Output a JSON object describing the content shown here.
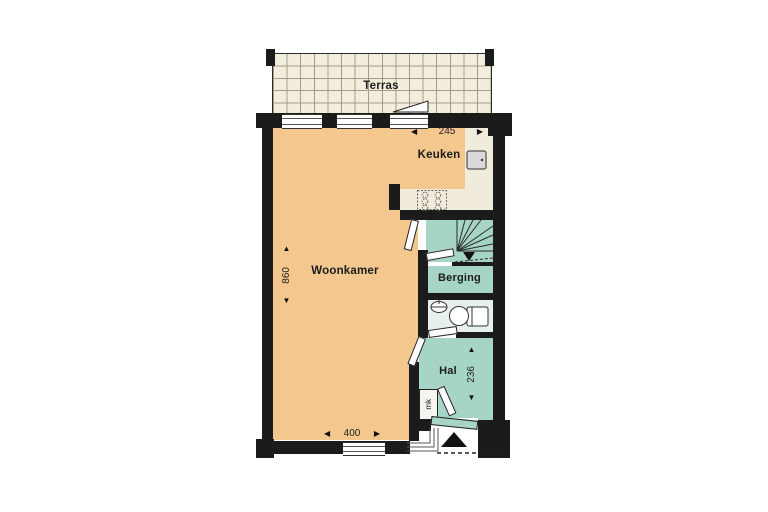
{
  "rooms": {
    "terras": "Terras",
    "woonkamer": "Woonkamer",
    "keuken": "Keuken",
    "berging": "Berging",
    "hal": "Hal",
    "meterkast": "mk"
  },
  "dimensions": {
    "keuken_width": "245",
    "woonkamer_depth": "860",
    "woonkamer_width": "400",
    "hal_depth": "236"
  },
  "icons": {
    "arrow_up": "▲",
    "arrow_down": "▼",
    "arrow_left": "◀",
    "arrow_right": "▶"
  },
  "colors": {
    "room_orange": "#F3C78E",
    "room_teal": "#A6D4C6",
    "room_pale": "#E7F0EC",
    "floor_cream": "#F1EBDB",
    "wall_black": "#1B1B1B",
    "terrace_tile": "#F3EDDE"
  }
}
